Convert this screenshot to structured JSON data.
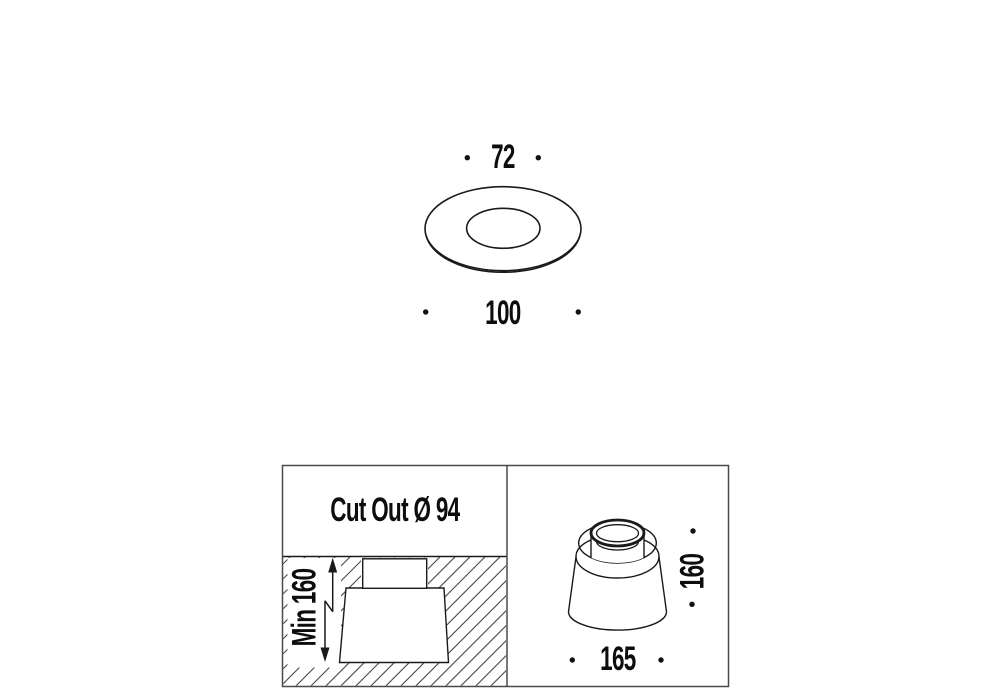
{
  "drawing": {
    "top_view": {
      "inner_diameter_label": "72",
      "outer_diameter_label": "100"
    },
    "installation_view": {
      "cutout_label": "Cut Out Ø 94",
      "min_depth_label": "Min 160"
    },
    "housing_view": {
      "height_label": "160",
      "width_label": "165"
    }
  },
  "colors": {
    "line": "#1a1a1a",
    "border": "#4a4a4a",
    "hatch": "#404040",
    "text": "#0d0d0d"
  }
}
